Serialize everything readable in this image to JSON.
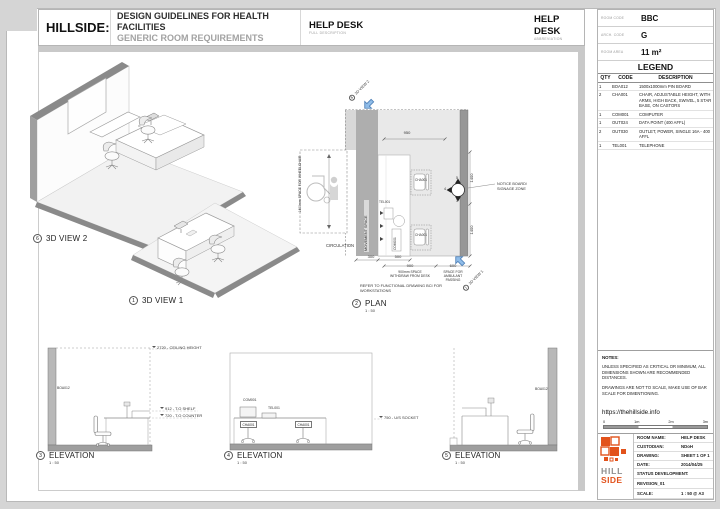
{
  "header": {
    "brand": "HILLSIDE:",
    "title1": "DESIGN GUIDELINES FOR HEALTH FACILITIES",
    "title2": "GENERIC ROOM REQUIREMENTS",
    "full": {
      "value": "HELP DESK",
      "caption": "FULL DESCRIPTION"
    },
    "abbr": {
      "value": "HELP DESK",
      "caption": "ABBREVIATION"
    }
  },
  "room_info": {
    "rows": [
      {
        "label": "ROOM CODE",
        "value": "BBC"
      },
      {
        "label": "ARCH. CODE",
        "value": "G"
      },
      {
        "label": "ROOM AREA",
        "value": "11 m²"
      }
    ]
  },
  "legend": {
    "title": "LEGEND",
    "col_qty": "QTY",
    "col_code": "CODE",
    "col_desc": "DESCRIPTION",
    "rows": [
      {
        "qty": "1",
        "code": "BOA012",
        "desc": "1500x1000mm PIN BOARD"
      },
      {
        "qty": "2",
        "code": "CHA001",
        "desc": "CHAIR, ADJUSTABLE HEIGHT, WITH ARMS, HIGH BACK, SWIVEL, 5 STAR BASE, ON CASTORS"
      },
      {
        "qty": "1",
        "code": "COM001",
        "desc": "COMPUTER"
      },
      {
        "qty": "1",
        "code": "OUT024",
        "desc": "DATA POINT (400 AFFL)"
      },
      {
        "qty": "2",
        "code": "OUT030",
        "desc": "OUTLET, POWER, SINGLE 16A - 400 AFFL"
      },
      {
        "qty": "1",
        "code": "TEL001",
        "desc": "TELEPHONE"
      }
    ]
  },
  "notes": {
    "title": "NOTES:",
    "para1": "UNLESS SPECIFIED AS CRITICAL OR MINIMUM, ALL DIMENSIONS SHOWN ARE RECOMMENDED DISTANCES.",
    "para2": "DRAWINGS ARE NOT TO SCALE, MAKE USE OF BAR SCALE FOR DIMENTIONING.",
    "link": "https://thehillside.info"
  },
  "scalebar": {
    "t0": "0",
    "t1": "1m",
    "t2": "2m",
    "t3": "3m"
  },
  "titleblock": {
    "logo_top": "HILL",
    "logo_bottom": "SIDE",
    "rows": [
      {
        "label": "ROOM NAME:",
        "value": "HELP DESK"
      },
      {
        "label": "CUSTODIAN:",
        "value": "NDoH"
      },
      {
        "label": "DRAWING:",
        "value": "SHEET 1 OF 1"
      },
      {
        "label": "DATE:",
        "value": "2014/04/25"
      }
    ],
    "status_label": "STATUS DEVELOPMENT:",
    "revision": "REVISION_01",
    "scale_label": "SCALE:",
    "scale_value": "1 : 50 @ A3"
  },
  "views": {
    "v6": {
      "num": "6",
      "name": "3D VIEW 2"
    },
    "v1": {
      "num": "1",
      "name": "3D VIEW 1"
    },
    "v2": {
      "num": "2",
      "name": "PLAN",
      "scale": "1 : 50"
    },
    "v3": {
      "num": "3",
      "name": "ELEVATION",
      "scale": "1 : 50"
    },
    "v4": {
      "num": "4",
      "name": "ELEVATION",
      "scale": "1 : 50"
    },
    "v5": {
      "num": "5",
      "name": "ELEVATION",
      "scale": "1 : 50"
    }
  },
  "plan": {
    "ref_view2": "3D VIEW 2",
    "ref_view1": "3D VIEW 1",
    "dim950": "950",
    "dim1400a": "1400",
    "dim1400b": "1400",
    "dim300": "300",
    "dim500": "500",
    "dim900": "900",
    "dim600": "600",
    "withdraw_note": "900mm SPACE WITHDRAW FROM DESK",
    "ambulant_note": "SPACE FOR AMBULANT PASSING",
    "wheelchair_note": "1400mm SPACE FOR WHEELCHAIR",
    "movement": "MOVEMENT SPACE",
    "circulation": "CIRCULATION",
    "notice": "NOTICE BOARD/ SIGNAGE ZONE",
    "refer_note": "REFER TO FUNCTIONAL DRAWING BCI FOR WORKSTATIONS",
    "tag_chair1": "CHA001",
    "tag_chair2": "CHA001",
    "tag_tel": "TEL001",
    "tag_com": "COM001",
    "marker_top": "5",
    "marker_left": "4",
    "marker_bottom": "3"
  },
  "elev3": {
    "ceiling": "2720 - CEILING HEIGHT",
    "shelf": "912 - T.O SHELF",
    "counter": "720 - T.O COUNTER",
    "board": "BOA012"
  },
  "elev4": {
    "com": "COM001",
    "tel": "TEL001",
    "chair1": "CHA001",
    "chair2": "CHA001",
    "socket": "750 - U/S SOCKET"
  },
  "elev5": {
    "board": "BOA012"
  },
  "colors": {
    "accent_orange": "#E2521B",
    "arrow_blue": "#8FBCE8",
    "wall_gray": "#8A8A8A"
  }
}
